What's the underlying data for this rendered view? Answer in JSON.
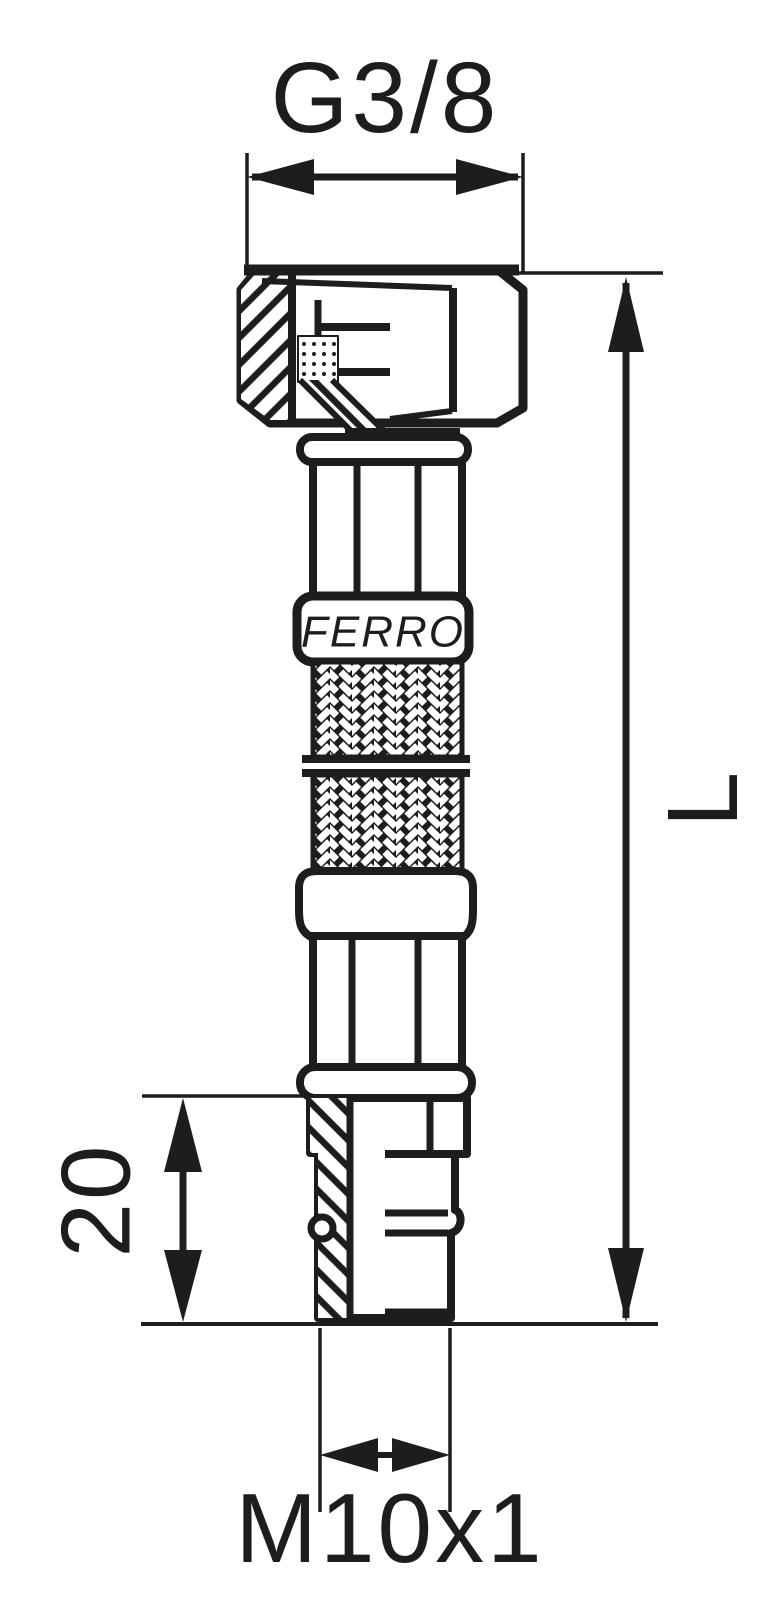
{
  "drawing": {
    "type": "technical-drawing",
    "subject": "flexible braided connection hose, angled female nut to straight male thread",
    "brand_label": "FERRO",
    "dim_top_thread": "G3/8",
    "dim_length": "L",
    "dim_tail_length": "20",
    "dim_bottom_thread": "M10x1",
    "line_color": "#1d1d1b",
    "bg_color": "#ffffff"
  }
}
